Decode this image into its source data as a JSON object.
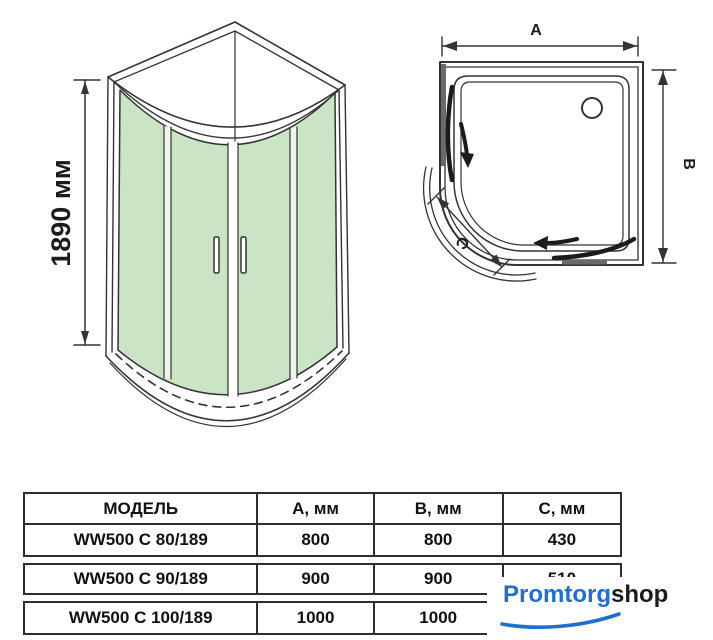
{
  "front_view": {
    "height_label": "1890 мм"
  },
  "top_view": {
    "width_label": "A",
    "depth_label": "B",
    "chord_label": "C"
  },
  "table": {
    "headers": {
      "model": "МОДЕЛЬ",
      "a": "А, мм",
      "b": "В, мм",
      "c": "С, мм"
    },
    "rows": [
      {
        "model": "WW500 C 80/189",
        "a": "800",
        "b": "800",
        "c": "430"
      },
      {
        "model": "WW500 C 90/189",
        "a": "900",
        "b": "900",
        "c": "510"
      },
      {
        "model": "WW500 C 100/189",
        "a": "1000",
        "b": "1000",
        "c": ""
      }
    ]
  },
  "watermark": {
    "brand_primary": "Promtorg",
    "brand_secondary": "shop"
  },
  "colors": {
    "glass_green": "#cbe4c6",
    "line": "#333333",
    "logo_blue": "#1f6fd0",
    "table_border": "#2e2e2e"
  }
}
